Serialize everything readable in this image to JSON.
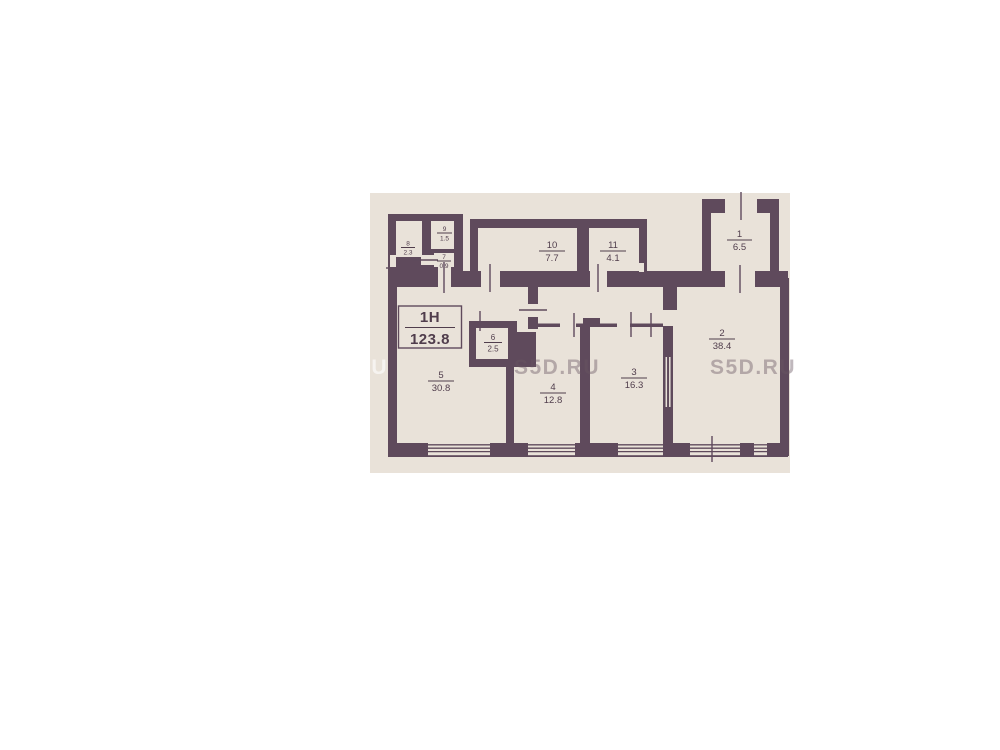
{
  "plan": {
    "title_box": {
      "name": "1Н",
      "area": "123.8"
    },
    "rooms": [
      {
        "number": "1",
        "area": "6.5"
      },
      {
        "number": "2",
        "area": "38.4"
      },
      {
        "number": "3",
        "area": "16.3"
      },
      {
        "number": "4",
        "area": "12.8"
      },
      {
        "number": "5",
        "area": "30.8"
      },
      {
        "number": "6",
        "area": "2.5"
      },
      {
        "number": "7",
        "area": "0.9"
      },
      {
        "number": "8",
        "area": "2.3"
      },
      {
        "number": "9",
        "area": "1.5"
      },
      {
        "number": "10",
        "area": "7.7"
      },
      {
        "number": "11",
        "area": "4.1"
      }
    ],
    "watermark": "S5D.RU",
    "colors": {
      "wall": "#5f4a5c",
      "floor": "#e9e2d9",
      "label": "#503d4c",
      "wm-dark": "rgba(104,86,98,0.42)",
      "wm-light": "rgba(255,255,255,0.6)"
    }
  }
}
